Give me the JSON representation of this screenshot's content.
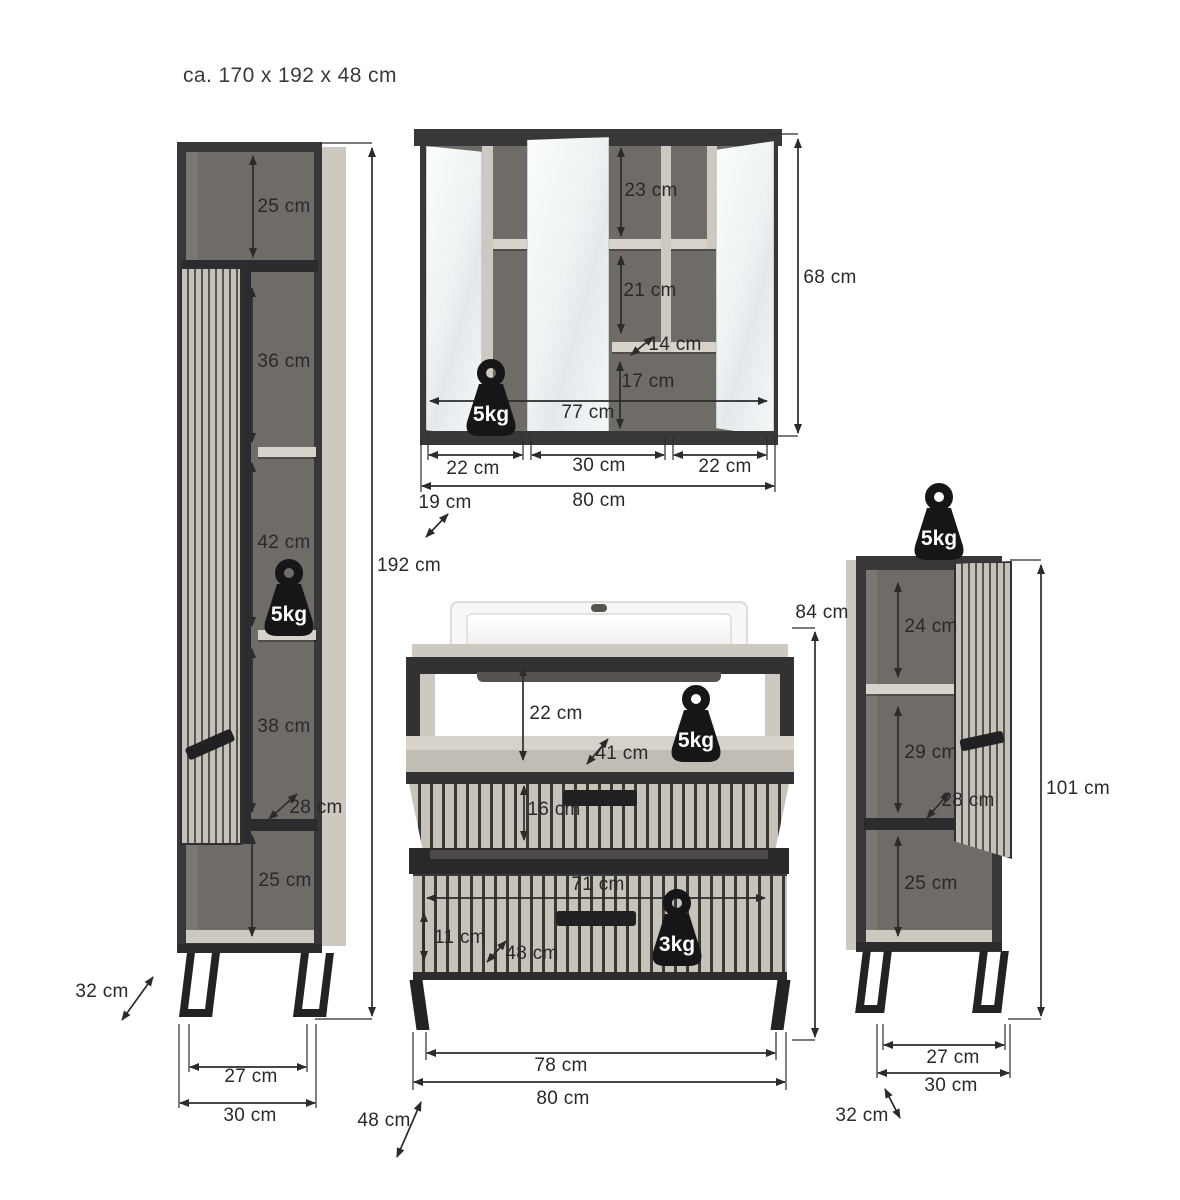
{
  "title": "ca. 170 x 192 x 48 cm",
  "badges": {
    "five_kg": "5kg",
    "three_kg": "3kg"
  },
  "labels": {
    "tall_top_compartment": "25 cm",
    "tall_shelf_36": "36 cm",
    "tall_shelf_42": "42 cm",
    "tall_shelf_38": "38 cm",
    "tall_inner_depth": "28 cm",
    "tall_bottom_compartment": "25 cm",
    "tall_height": "192 cm",
    "tall_depth": "32 cm",
    "tall_feet_width": "27 cm",
    "tall_width": "30 cm",
    "mirror_shelf_23": "23 cm",
    "mirror_shelf_21": "21 cm",
    "mirror_inner_depth": "14 cm",
    "mirror_bottom_height": "17 cm",
    "mirror_inner_width": "77 cm",
    "mirror_height": "68 cm",
    "mirror_door_left": "22 cm",
    "mirror_door_center": "30 cm",
    "mirror_door_right": "22 cm",
    "mirror_width": "80 cm",
    "mirror_depth": "19 cm",
    "vanity_height": "84 cm",
    "vanity_open_height": "22 cm",
    "vanity_open_depth": "41 cm",
    "vanity_drawer1_height": "16 cm",
    "vanity_drawer_width": "71 cm",
    "vanity_drawer2_height": "11 cm",
    "vanity_drawer_depth": "48 cm",
    "vanity_feet_width": "78 cm",
    "vanity_width": "80 cm",
    "vanity_depth": "48 cm",
    "side_shelf_24": "24 cm",
    "side_shelf_29": "29 cm",
    "side_inner_depth": "28 cm",
    "side_height": "101 cm",
    "side_bottom_compartment": "25 cm",
    "side_feet_width": "27 cm",
    "side_width": "30 cm",
    "side_depth": "32 cm"
  }
}
